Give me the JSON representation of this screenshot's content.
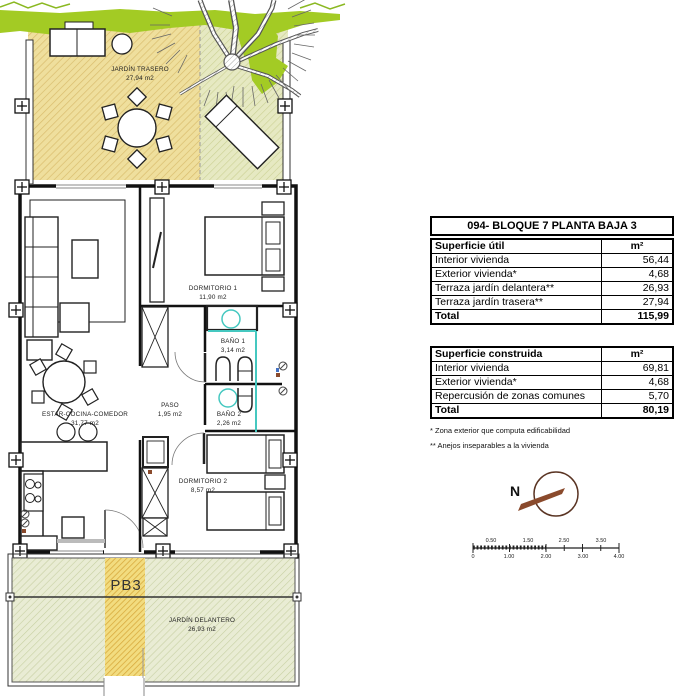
{
  "title": "094- BLOQUE 7 PLANTA BAJA 3",
  "surface_util_table": {
    "header_label": "Superficie útil",
    "header_unit": "m²",
    "rows": [
      {
        "label": "Interior vivienda",
        "value": "56,44"
      },
      {
        "label": "Exterior vivienda*",
        "value": "4,68"
      },
      {
        "label": "Terraza jardín delantera**",
        "value": "26,93"
      },
      {
        "label": "Terraza jardín trasera**",
        "value": "27,94"
      }
    ],
    "total_label": "Total",
    "total_value": "115,99"
  },
  "surface_built_table": {
    "header_label": "Superficie construida",
    "header_unit": "m²",
    "rows": [
      {
        "label": "Interior vivienda",
        "value": "69,81"
      },
      {
        "label": "Exterior vivienda*",
        "value": "4,68"
      },
      {
        "label": "Repercusión de zonas comunes",
        "value": "5,70"
      }
    ],
    "total_label": "Total",
    "total_value": "80,19"
  },
  "footnotes": {
    "note1": "* Zona exterior que computa edificabilidad",
    "note2": "** Anejos inseparables a la vivienda"
  },
  "compass": {
    "north_label": "N"
  },
  "scale_bar": {
    "top_ticks": [
      "0.50",
      "1.50",
      "2.50",
      "3.50"
    ],
    "bottom_ticks": [
      "0",
      "1.00",
      "2.00",
      "3.00",
      "4.00"
    ]
  },
  "floor_plan": {
    "unit_label": "PB3",
    "rooms": {
      "jardin_trasero": {
        "name": "JARDÍN TRASERO",
        "area": "27,94 m2"
      },
      "dormitorio1": {
        "name": "DORMITORIO 1",
        "area": "11,90 m2"
      },
      "bano1": {
        "name": "BAÑO 1",
        "area": "3,14 m2"
      },
      "estar": {
        "name": "ESTAR-COCINA-COMEDOR",
        "area": "31,77 m2"
      },
      "paso": {
        "name": "PASO",
        "area": "1,95 m2"
      },
      "bano2": {
        "name": "BAÑO 2",
        "area": "2,26 m2"
      },
      "dormitorio2": {
        "name": "DORMITORIO 2",
        "area": "8,57 m2"
      },
      "jardin_delantero": {
        "name": "JARDÍN DELANTERO",
        "area": "26,93 m2"
      }
    }
  },
  "colors": {
    "hatch_yellow": "#efdf9d",
    "hatch_yellow_dense": "#f2dc7f",
    "hatch_green": "#e9ecd4",
    "vegetation_green": "#a3cb24",
    "fixture_teal": "#45c8c0",
    "compass_brown": "#8a4a2c"
  }
}
